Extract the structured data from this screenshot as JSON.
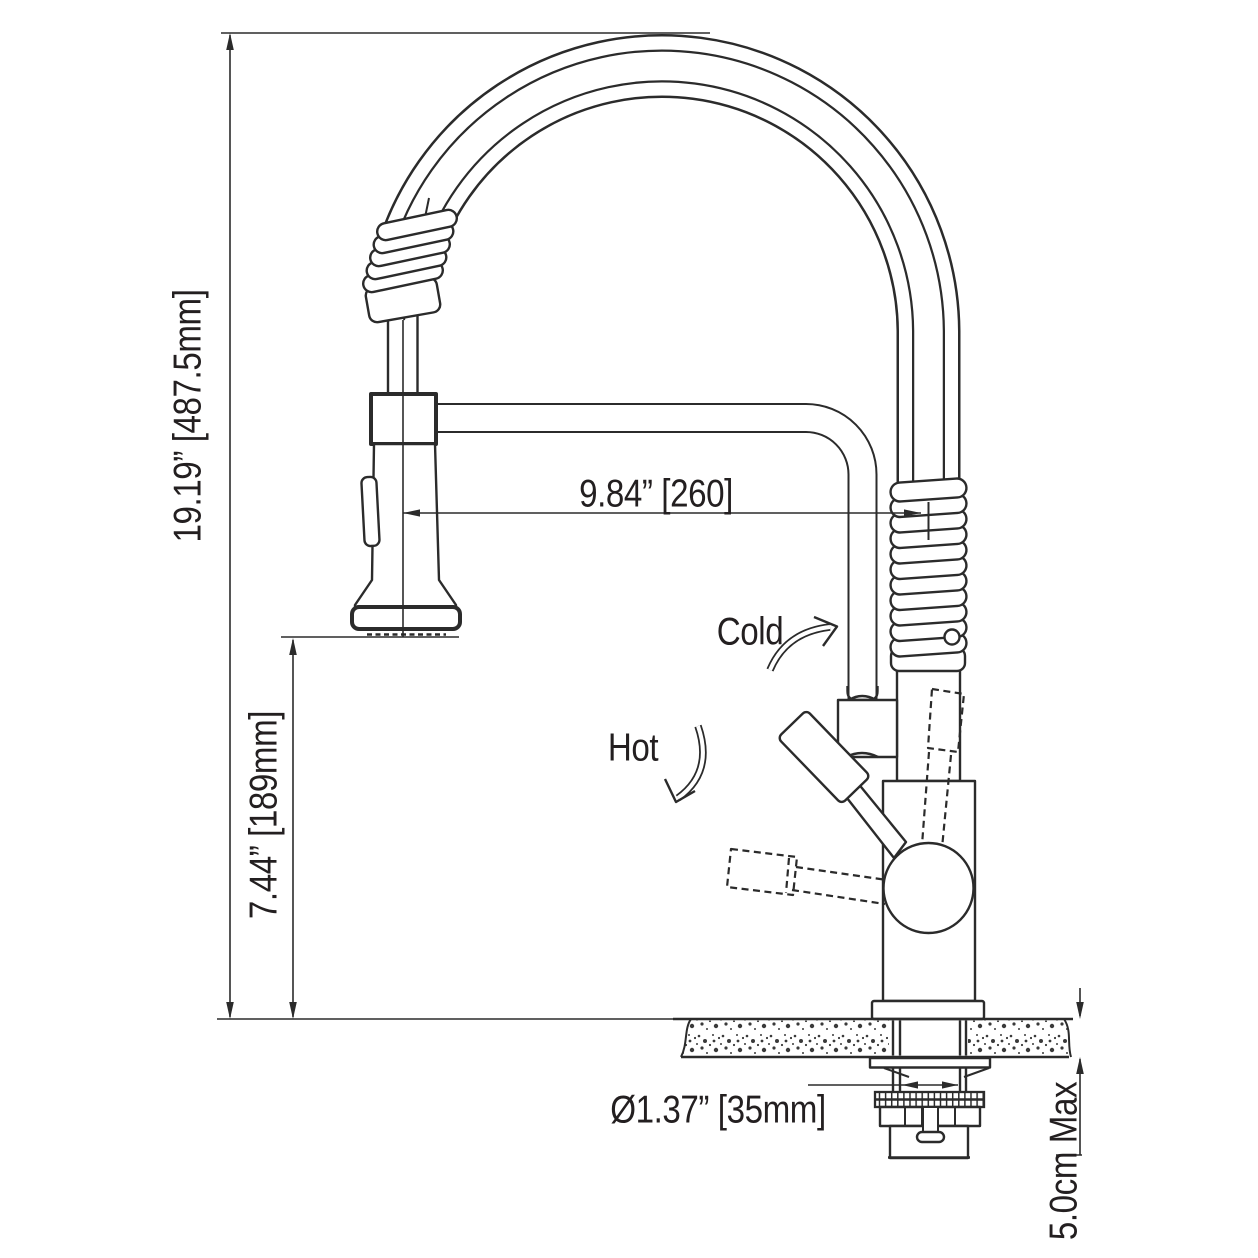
{
  "dimensions": {
    "overall_height": "19.19” [487.5mm]",
    "spout_reach": "9.84” [260]",
    "spray_head_height": "7.44” [189mm]",
    "mounting_hole_diameter": "Ø1.37” [35mm]",
    "max_counter_thickness": "5.0cm Max"
  },
  "annotations": {
    "cold": "Cold",
    "hot": "Hot"
  },
  "colors": {
    "line": "#2b2b2b",
    "text": "#231f20",
    "background": "#ffffff"
  }
}
